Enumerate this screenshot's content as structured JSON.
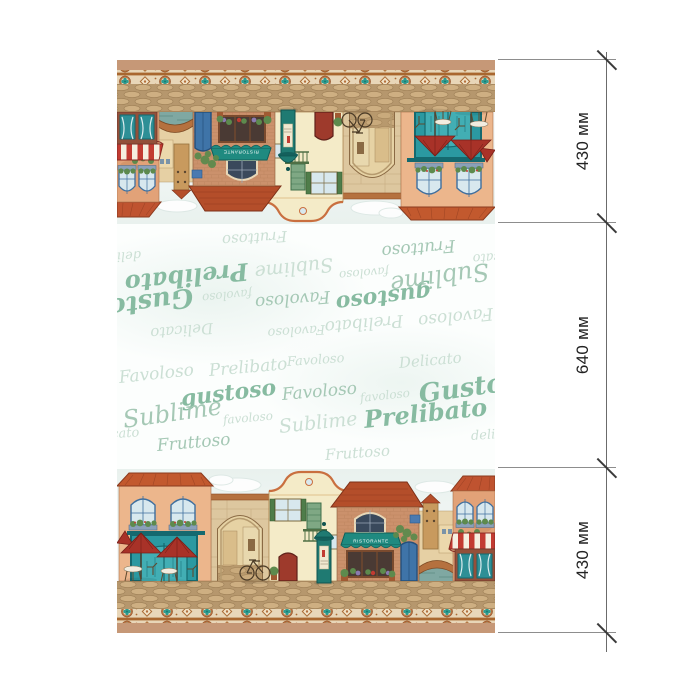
{
  "dimensions": {
    "top": "430 мм",
    "middle": "640 мм",
    "bottom": "430 мм"
  },
  "scene": {
    "awning_sign": "RISTORANTE"
  },
  "pattern_words": [
    {
      "text": "Favoloso",
      "x": 2,
      "y": 24,
      "size": 17,
      "cls": "wl",
      "rot": -6
    },
    {
      "text": "Prelibato",
      "x": 92,
      "y": 17,
      "size": 17,
      "cls": "wl",
      "rot": -5
    },
    {
      "text": "Favoloso",
      "x": 170,
      "y": 10,
      "size": 13,
      "cls": "wl",
      "rot": -4
    },
    {
      "text": "Delicato",
      "x": 282,
      "y": 10,
      "size": 15,
      "cls": "wl",
      "rot": -5
    },
    {
      "text": "gustoso",
      "x": 64,
      "y": 42,
      "size": 22,
      "cls": "wb",
      "rot": -7
    },
    {
      "text": "Favoloso",
      "x": 165,
      "y": 41,
      "size": 17,
      "cls": "wm",
      "rot": -5
    },
    {
      "text": "favoloso",
      "x": 243,
      "y": 46,
      "size": 12,
      "cls": "wl",
      "rot": -6
    },
    {
      "text": "Gustoso",
      "x": 302,
      "y": 36,
      "size": 26,
      "cls": "wb",
      "rot": -8
    },
    {
      "text": "Sublime",
      "x": 6,
      "y": 62,
      "size": 24,
      "cls": "wm",
      "rot": -8
    },
    {
      "text": "favoloso",
      "x": 106,
      "y": 68,
      "size": 12,
      "cls": "wl",
      "rot": -5
    },
    {
      "text": "Sublime",
      "x": 162,
      "y": 72,
      "size": 19,
      "cls": "wl",
      "rot": -6
    },
    {
      "text": "Prelibato",
      "x": 247,
      "y": 62,
      "size": 24,
      "cls": "wb",
      "rot": -6
    },
    {
      "text": "delicato",
      "x": 354,
      "y": 84,
      "size": 13,
      "cls": "wl",
      "rot": -4
    },
    {
      "text": "delicato",
      "x": -30,
      "y": 84,
      "size": 13,
      "cls": "wl",
      "rot": -4
    },
    {
      "text": "Fruttoso",
      "x": 40,
      "y": 92,
      "size": 17,
      "cls": "wm",
      "rot": -5
    },
    {
      "text": "Fruttoso",
      "x": 208,
      "y": 102,
      "size": 15,
      "cls": "wl",
      "rot": -4
    }
  ],
  "colors": {
    "tan_strip": "#c69877",
    "word_light": "#cbdfd4",
    "word_mid": "#a5c8b5",
    "word_bold": "#87bba1",
    "dim_line": "#6b6b6b",
    "dim_tick": "#3a3a3a",
    "dim_text": "#222222",
    "teal": "#2b99a1",
    "roof": "#c2592e",
    "awning_teal": "#1f8a80",
    "umbrella_red": "#a83228"
  }
}
